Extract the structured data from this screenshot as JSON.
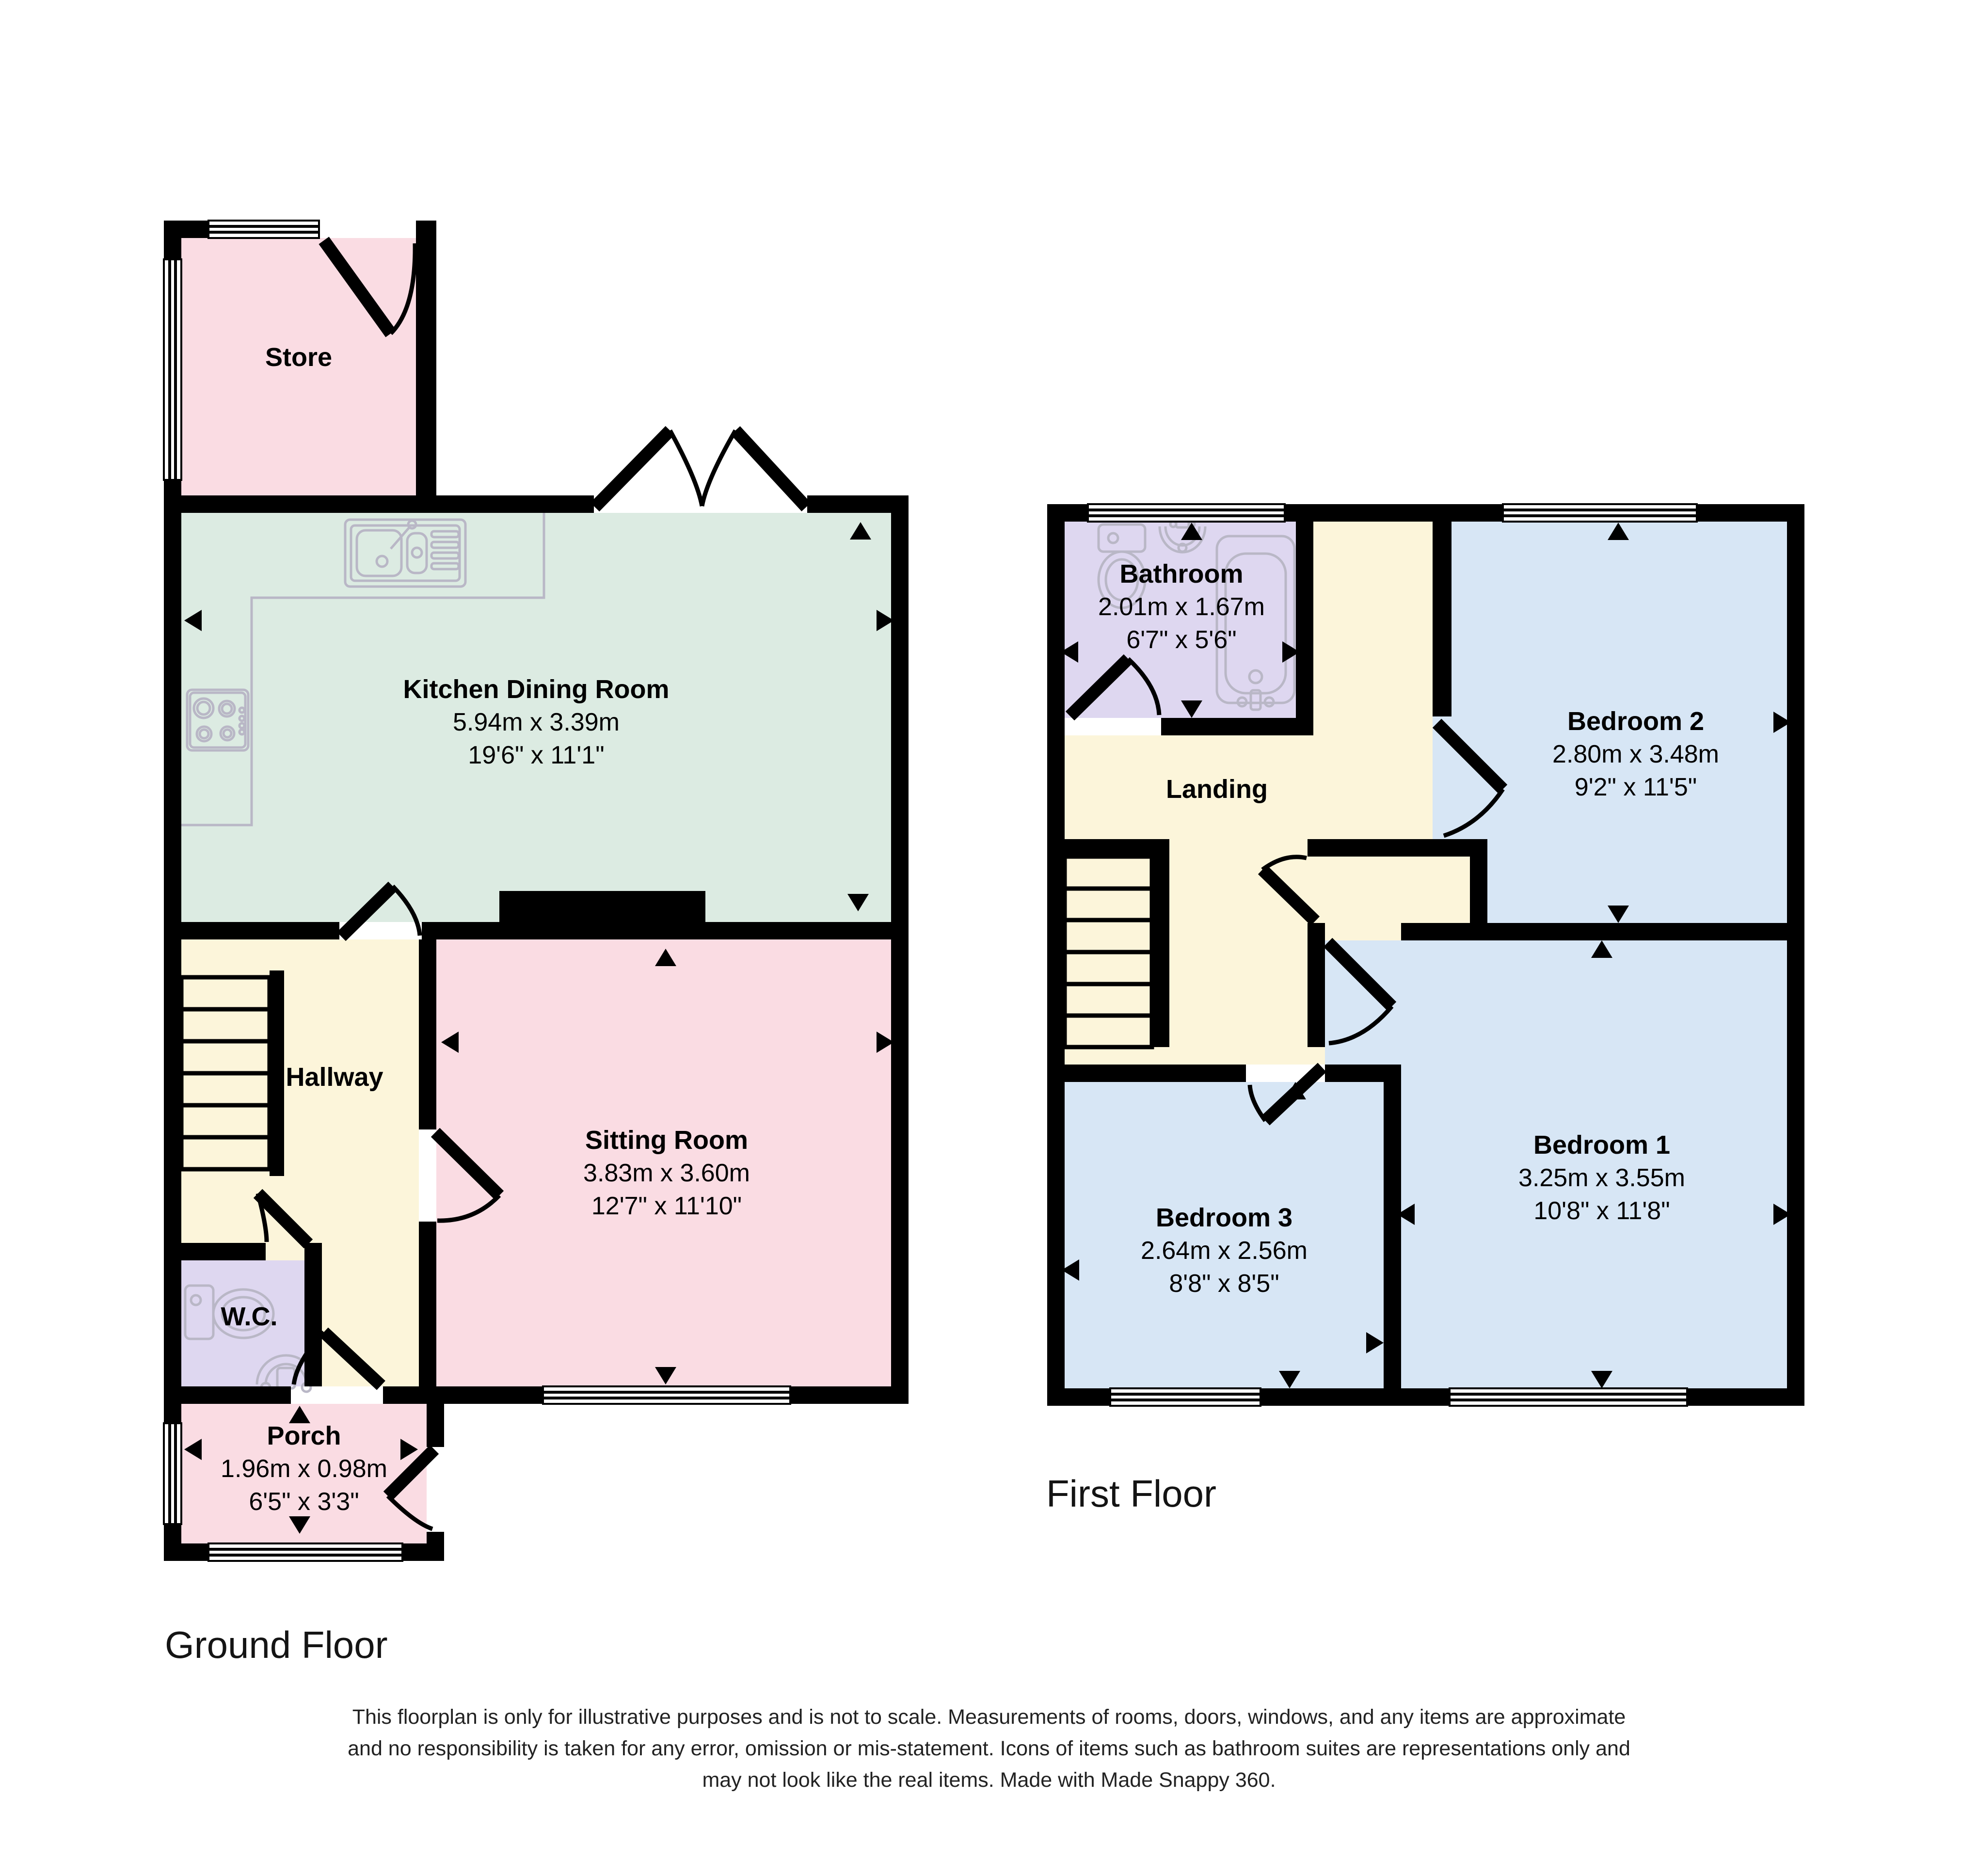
{
  "palette": {
    "wall": "#000000",
    "pink": "#fadce3",
    "mint": "#dcebe2",
    "cream": "#fcf5da",
    "lavender": "#ded7f0",
    "blue": "#d7e6f5",
    "fixture_outline": "#b9b7c6"
  },
  "floors": [
    {
      "title": "Ground Floor",
      "rooms": [
        {
          "name": "Store"
        },
        {
          "name": "Kitchen Dining Room",
          "metric": "5.94m x 3.39m",
          "imperial": "19'6\" x 11'1\""
        },
        {
          "name": "Hallway"
        },
        {
          "name": "Sitting Room",
          "metric": "3.83m x 3.60m",
          "imperial": "12'7\" x 11'10\""
        },
        {
          "name": "W.C."
        },
        {
          "name": "Porch",
          "metric": "1.96m x 0.98m",
          "imperial": "6'5\" x 3'3\""
        }
      ]
    },
    {
      "title": "First Floor",
      "rooms": [
        {
          "name": "Bathroom",
          "metric": "2.01m x 1.67m",
          "imperial": "6'7\" x 5'6\""
        },
        {
          "name": "Landing"
        },
        {
          "name": "Bedroom 2",
          "metric": "2.80m x 3.48m",
          "imperial": "9'2\" x 11'5\""
        },
        {
          "name": "Bedroom 1",
          "metric": "3.25m x 3.55m",
          "imperial": "10'8\" x 11'8\""
        },
        {
          "name": "Bedroom 3",
          "metric": "2.64m x 2.56m",
          "imperial": "8'8\" x 8'5\""
        }
      ]
    }
  ],
  "disclaimer": {
    "lines": [
      "This floorplan is only for illustrative purposes and is not to scale. Measurements of rooms, doors, windows, and any items are approximate",
      "and no responsibility is taken for any error, omission or mis-statement. Icons of items such as bathroom suites are representations only and",
      "may not look like the real items. Made with Made Snappy 360."
    ]
  }
}
